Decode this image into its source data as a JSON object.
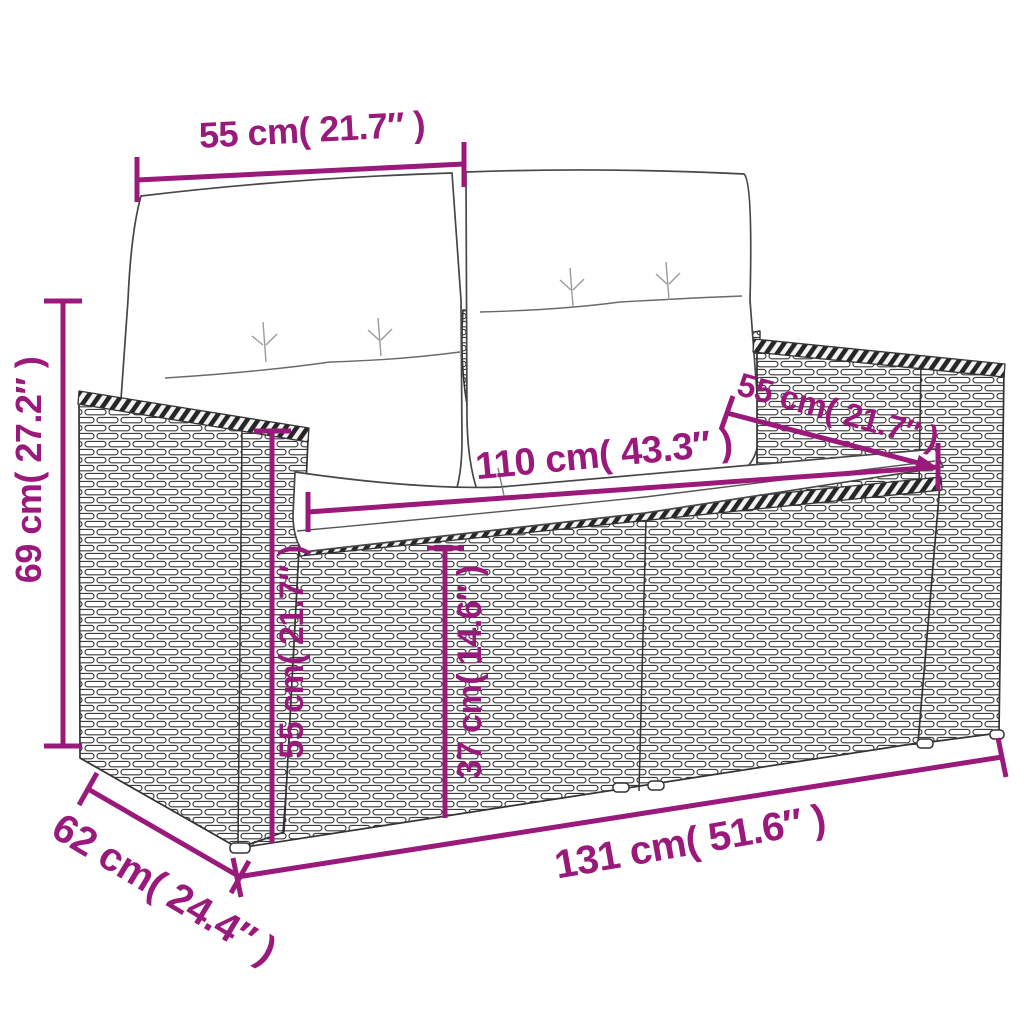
{
  "figure": {
    "type": "product-dimension-diagram",
    "colors": {
      "accent": "#9a1a7b",
      "sketch_line": "#3a3a3a",
      "background": "#ffffff"
    },
    "dimensions": {
      "back_cushion_width": "55 cm( 21.7″ )",
      "overall_height": "69 cm( 27.2″ )",
      "seat_width": "110 cm( 43.3″ )",
      "backrest_depth": "55 cm( 21.7″ )",
      "armrest_height": "55 cm( 21.7″ )",
      "seat_height": "37 cm( 14.6″ )",
      "overall_width": "131 cm( 51.6″ )",
      "overall_depth": "62 cm( 24.4″ )"
    }
  }
}
